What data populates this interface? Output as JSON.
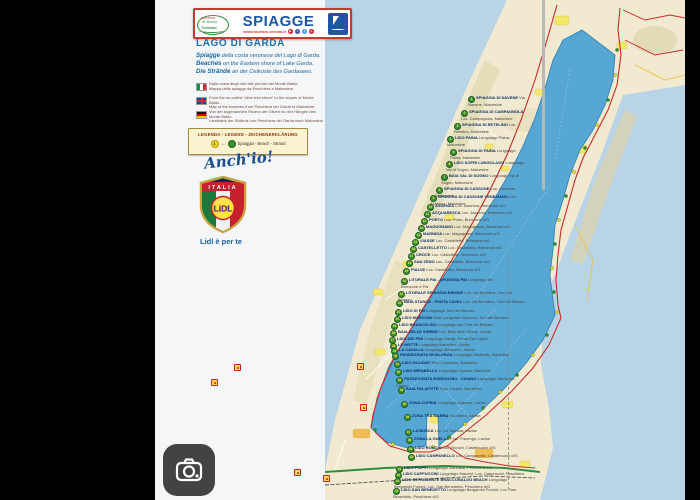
{
  "header": {
    "brand": {
      "line1": "provincia",
      "line2": "di Verona",
      "line3": "Turismo"
    },
    "title": "SPIAGGE",
    "url": "www.tourism.verona.it",
    "social": [
      {
        "name": "youtube-icon",
        "glyph": "▶",
        "color": "#cc2222"
      },
      {
        "name": "facebook-icon",
        "glyph": "f",
        "color": "#3a5a98"
      },
      {
        "name": "twitter-icon",
        "glyph": "t",
        "color": "#45a9e5"
      },
      {
        "name": "pinterest-icon",
        "glyph": "p",
        "color": "#c8232c"
      }
    ]
  },
  "intro": {
    "title": "LAGO DI GARDA",
    "lines": [
      {
        "lead": "Spiagge",
        "rest": " della costa veronese del Lago di Garda."
      },
      {
        "lead": "Beaches",
        "rest": " on the Eastern shore of Lake Garda."
      },
      {
        "lead": "Die Strände",
        "rest": " an der Ostküste des Gardasees."
      }
    ]
  },
  "flag_notes": [
    {
      "flag": "it",
      "line1": "Dalla costa degli olivi alle pendici del Monte Baldo.",
      "line2": "Mappa delle spiagge da Peschiera a Malcesine."
    },
    {
      "flag": "en",
      "line1": "From the so-called “olive tree shore” to the slopes of Monte Baldo.",
      "line2": "Map of the beaches from Peschiera del Garda to Malcesine."
    },
    {
      "flag": "de",
      "line1": "Von der sogenannten Riviera der Oliven zu den Hängen des Monte Baldo.",
      "line2": "Landkarte der Strände von Peschiera del Garda nach Malcesine."
    }
  ],
  "legend": {
    "title": "LEGENDA - LEGEND - ZEICHENERKLÄRUNG",
    "marker_number": "1",
    "arrow": "→",
    "beach_glyph": "⛱",
    "label": "Spiaggia - Beach - Strand"
  },
  "promo": {
    "handwritten": "Anch'io!",
    "shield_country": "ITALIA",
    "lidl_wordmark": "LiDL",
    "tagline": "Lidl è per te"
  },
  "lake_letters": [
    {
      "ch": "L",
      "x": 265,
      "y": 383,
      "s": 14
    },
    {
      "ch": "a",
      "x": 277,
      "y": 366,
      "s": 14
    },
    {
      "ch": "g",
      "x": 288,
      "y": 349,
      "s": 14
    },
    {
      "ch": "o",
      "x": 300,
      "y": 333,
      "s": 14
    },
    {
      "ch": "d",
      "x": 318,
      "y": 300,
      "s": 10
    },
    {
      "ch": "i",
      "x": 327,
      "y": 289,
      "s": 10
    },
    {
      "ch": "G",
      "x": 345,
      "y": 252,
      "s": 14
    },
    {
      "ch": "a",
      "x": 360,
      "y": 226,
      "s": 14
    },
    {
      "ch": "r",
      "x": 372,
      "y": 201,
      "s": 14
    },
    {
      "ch": "d",
      "x": 383,
      "y": 176,
      "s": 14
    },
    {
      "ch": "a",
      "x": 395,
      "y": 150,
      "s": 14
    }
  ],
  "towns": [
    {
      "label": "RIVA del Garda",
      "x": 406,
      "y": 22,
      "cls": "t-md"
    },
    {
      "label": "TORBOLE",
      "x": 467,
      "y": 50,
      "cls": "t-md"
    },
    {
      "label": "LIMONE sul Garda",
      "x": 376,
      "y": 95,
      "cls": "t-md"
    },
    {
      "label": "TREMOSINE",
      "x": 333,
      "y": 148,
      "cls": "t-sm"
    },
    {
      "label": "TIGNALE",
      "x": 349,
      "y": 170,
      "cls": "t-sm"
    },
    {
      "label": "GARGNANO",
      "x": 294,
      "y": 220,
      "cls": "t-sm"
    },
    {
      "label": "TOSCOLANO",
      "x": 252,
      "y": 268,
      "cls": "t-sm"
    },
    {
      "label": "SALÒ",
      "x": 224,
      "y": 296,
      "cls": "t-sm"
    },
    {
      "label": "MANERBA del Garda",
      "x": 226,
      "y": 354,
      "cls": "t-sm"
    },
    {
      "label": "DESENZANO del Garda",
      "x": 212,
      "y": 437,
      "cls": "t-md"
    },
    {
      "label": "SIRMIONE",
      "x": 290,
      "y": 421,
      "cls": "t-sm"
    },
    {
      "label": "PESCHIERA del Garda",
      "x": 330,
      "y": 457,
      "cls": "t-md"
    },
    {
      "label": "Castelnuovo del Garda",
      "x": 370,
      "y": 466,
      "cls": "t-sm"
    },
    {
      "label": "LAZISE",
      "x": 349,
      "y": 406,
      "cls": "t-lg"
    },
    {
      "label": "BARDOLINO",
      "x": 337,
      "y": 367,
      "cls": "t-lg"
    },
    {
      "label": "GARDA",
      "x": 331,
      "y": 341,
      "cls": "t-lg"
    },
    {
      "label": "TORRI del Benaco",
      "x": 375,
      "y": 303,
      "cls": "t-sm"
    },
    {
      "label": "BRENZONE sul Garda",
      "x": 394,
      "y": 220,
      "cls": "t-md"
    },
    {
      "label": "MALCESINE",
      "x": 425,
      "y": 151,
      "cls": "t-lg"
    }
  ],
  "beaches": [
    {
      "n": 1,
      "x": 468,
      "y": 96,
      "w": 58,
      "name": "SPIAGGIA DI NAVENE",
      "sub": "Via Navene, Malcesine"
    },
    {
      "n": 2,
      "x": 461,
      "y": 110,
      "w": 65,
      "name": "SPIAGGIA DI CAMPAGNOLA",
      "sub": "Loc. Campagnola, Malcesine"
    },
    {
      "n": 3,
      "x": 454,
      "y": 123,
      "w": 72,
      "name": "SPIAGGIA DI RETELINO",
      "sub": "Loc. Retelino, Malcesine"
    },
    {
      "n": 4,
      "x": 447,
      "y": 136,
      "w": 79,
      "name": "LIDO PAINA",
      "sub": "Lungolago Paina, Malcesine"
    },
    {
      "n": 5,
      "x": 450,
      "y": 149,
      "w": 76,
      "name": "SPIAGGIA DI PAINA",
      "sub": "Lungolago Paina, Malcesine"
    },
    {
      "n": 6,
      "x": 446,
      "y": 161,
      "w": 80,
      "name": "LIDO SOPRI LUNGOLAGO",
      "sub": "Lungolago Val di Sogno, Malcesine"
    },
    {
      "n": 7,
      "x": 441,
      "y": 174,
      "w": 85,
      "name": "BAIA VAL DI SOGNO",
      "sub": "Lungolago Val di Sogno, Malcesine"
    },
    {
      "n": 8,
      "x": 436,
      "y": 187,
      "w": 90,
      "name": "SPIAGGIA DI CASSONE",
      "sub": "Loc. Cassone, Malcesine"
    },
    {
      "n": 9,
      "x": 430,
      "y": 195,
      "w": 96,
      "name": "SPIAGGIA DI CASSONE VENEZIANO",
      "sub": "Loc. Assenza, Malcesine"
    },
    {
      "n": 10,
      "x": 427,
      "y": 204,
      "w": 99,
      "name": "ASSENZA",
      "sub": "Loc. Assenza, Brenzone s/G"
    },
    {
      "n": 11,
      "x": 424,
      "y": 211,
      "w": 102,
      "name": "ACQUARESCA",
      "sub": "Loc. Assenza, Brenzone s/G"
    },
    {
      "n": 12,
      "x": 421,
      "y": 218,
      "w": 105,
      "name": "PORTO",
      "sub": "Loc. Porto, Brenzone s/G"
    },
    {
      "n": 13,
      "x": 418,
      "y": 225,
      "w": 108,
      "name": "MAGUGNANO",
      "sub": "Loc. Magugnano, Brenzone s/G"
    },
    {
      "n": 14,
      "x": 415,
      "y": 232,
      "w": 111,
      "name": "MARNIGA",
      "sub": "Loc. Magugnano, Brenzone s/G"
    },
    {
      "n": 15,
      "x": 412,
      "y": 239,
      "w": 114,
      "name": "VIASSE",
      "sub": "Loc. Castelletto, Brenzone s/G"
    },
    {
      "n": 16,
      "x": 410,
      "y": 246,
      "w": 116,
      "name": "CASTELLETTO",
      "sub": "Loc. Castelletto, Brenzone s/G"
    },
    {
      "n": 17,
      "x": 408,
      "y": 253,
      "w": 118,
      "name": "CROCE",
      "sub": "Loc. Castelletto, Brenzone s/G"
    },
    {
      "n": 18,
      "x": 406,
      "y": 260,
      "w": 120,
      "name": "SAN ZENO",
      "sub": "Loc. Castelletto, Brenzone s/G"
    },
    {
      "n": 19,
      "x": 403,
      "y": 268,
      "w": 123,
      "name": "PIALVE",
      "sub": "Loc. Castelletto, Brenzone s/G"
    },
    {
      "n": 20,
      "x": 401,
      "y": 278,
      "w": 100,
      "name": "LITORALE PAI - SPIAGGIA PAI",
      "sub": "Lungolago tra Brenzone e Pai"
    },
    {
      "n": 21,
      "x": 398,
      "y": 291,
      "w": 128,
      "name": "LITORALE SPIAGGIA BRIONE",
      "sub": "Loc. Val Brendine, Torri del Benaco"
    },
    {
      "n": 22,
      "x": 396,
      "y": 300,
      "w": 130,
      "name": "BAIA STANCA - PUNTA CAVAL",
      "sub": "Loc. Val Brendine, Torri del Benaco"
    },
    {
      "n": 23,
      "x": 395,
      "y": 309,
      "w": 131,
      "name": "LIDO DI PAI",
      "sub": "Lungolago Torri del Benaco"
    },
    {
      "n": 24,
      "x": 394,
      "y": 316,
      "w": 132,
      "name": "LIDO MARCONI",
      "sub": "Viale Lungolario Marconi, Torri del Benaco"
    },
    {
      "n": 25,
      "x": 391,
      "y": 323,
      "w": 135,
      "name": "LIDO BRANCOLINO",
      "sub": "Lungolago per Torri del Benaco"
    },
    {
      "n": 26,
      "x": 390,
      "y": 330,
      "w": 136,
      "name": "BAIA DELLE SIRENE",
      "sub": "Loc. Baia delle Sirene, Garda"
    },
    {
      "n": 27,
      "x": 389,
      "y": 337,
      "w": 137,
      "name": "LIDO DEI PINI",
      "sub": "Lungolago Garda, Punta San Vigilio"
    },
    {
      "n": 28,
      "x": 390,
      "y": 343,
      "w": 136,
      "name": "LE MOTTE",
      "sub": "Lungolago Bardolino, Garda"
    },
    {
      "n": 29,
      "x": 391,
      "y": 348,
      "w": 135,
      "name": "LA CAVALLA",
      "sub": "Lungolago Bardolino, Garda"
    },
    {
      "n": 30,
      "x": 392,
      "y": 353,
      "w": 134,
      "name": "PASSEGGIATA RIVALUNGA",
      "sub": "Lungolago Mirabello, Bardolino"
    },
    {
      "n": 31,
      "x": 394,
      "y": 361,
      "w": 132,
      "name": "LIDO HOLIDAY",
      "sub": "Riva Cornicello, Bardolino"
    },
    {
      "n": 32,
      "x": 395,
      "y": 369,
      "w": 131,
      "name": "LIDO MIRABELLO",
      "sub": "Lungolago Cipriani, Bardolino"
    },
    {
      "n": 33,
      "x": 396,
      "y": 377,
      "w": 130,
      "name": "PASSEGGIATA BARDOLINO - CISANO",
      "sub": "Lungolago Bardolino-Cisano"
    },
    {
      "n": 34,
      "x": 398,
      "y": 387,
      "w": 128,
      "name": "BAIA PALAFITTE",
      "sub": "Fraz. Cisano, Bardolino"
    },
    {
      "n": 35,
      "x": 401,
      "y": 401,
      "w": 125,
      "name": "ZONA CUPRIA",
      "sub": "Lungolago Caprera, Lazise"
    },
    {
      "n": 36,
      "x": 404,
      "y": 414,
      "w": 122,
      "name": "ZONA TRA MARRA",
      "sub": "Via Marra, Lazise"
    },
    {
      "n": 37,
      "x": 405,
      "y": 429,
      "w": 121,
      "name": "LA BUSCA",
      "sub": "Loc. La Tonnara, Lazise"
    },
    {
      "n": 38,
      "x": 406,
      "y": 437,
      "w": 120,
      "name": "ZONA LA GUELLA",
      "sub": "Fraz. Pacengo, Lazise"
    },
    {
      "n": 39,
      "x": 407,
      "y": 446,
      "w": 119,
      "name": "LIDO RONCHI",
      "sub": "Loc. Ronchi, Castelnuovo d/G"
    },
    {
      "n": 40,
      "x": 408,
      "y": 454,
      "w": 118,
      "name": "LIDO CAMPANELLO",
      "sub": "Loc. Campanello, Castelnuovo d/G"
    },
    {
      "n": 41,
      "x": 396,
      "y": 466,
      "w": 130,
      "name": "LIDO PIOPPI",
      "sub": "Lungolago Garibaldi, Peschiera d/G"
    },
    {
      "n": 42,
      "x": 395,
      "y": 472,
      "w": 131,
      "name": "LIDO CAPPUCCINI",
      "sub": "Lungolago Mazzini, Loc. Cappuccini, Peschiera d/G"
    },
    {
      "n": 43,
      "x": 394,
      "y": 478,
      "w": 132,
      "name": "LIDO BERGAMINI E BRACCOBALDO BEACH",
      "sub": "Lungolago Bergamini Furioni, Loc. San Benedetto, Peschiera d/G"
    },
    {
      "n": 44,
      "x": 393,
      "y": 488,
      "w": 133,
      "name": "LIDO SAN BENEDETTO",
      "sub": "Lungolago Bergamini Furioni, Loc. San Benedetto, Peschiera d/G"
    }
  ],
  "lidl_stores": [
    {
      "x": 234,
      "y": 364
    },
    {
      "x": 357,
      "y": 363
    },
    {
      "x": 360,
      "y": 404
    },
    {
      "x": 294,
      "y": 469
    },
    {
      "x": 323,
      "y": 475
    },
    {
      "x": 211,
      "y": 379
    }
  ],
  "colors": {
    "brand_blue": "#1b57a5",
    "accent_red": "#c43a2e",
    "lake_blue": "#57a7d4",
    "paper_blue": "#b9d3e7",
    "land": "#f1ead0",
    "legend_bg": "#faf3d0",
    "lidl_yellow": "#ffe14c",
    "highway_green": "#2f8f3f"
  }
}
